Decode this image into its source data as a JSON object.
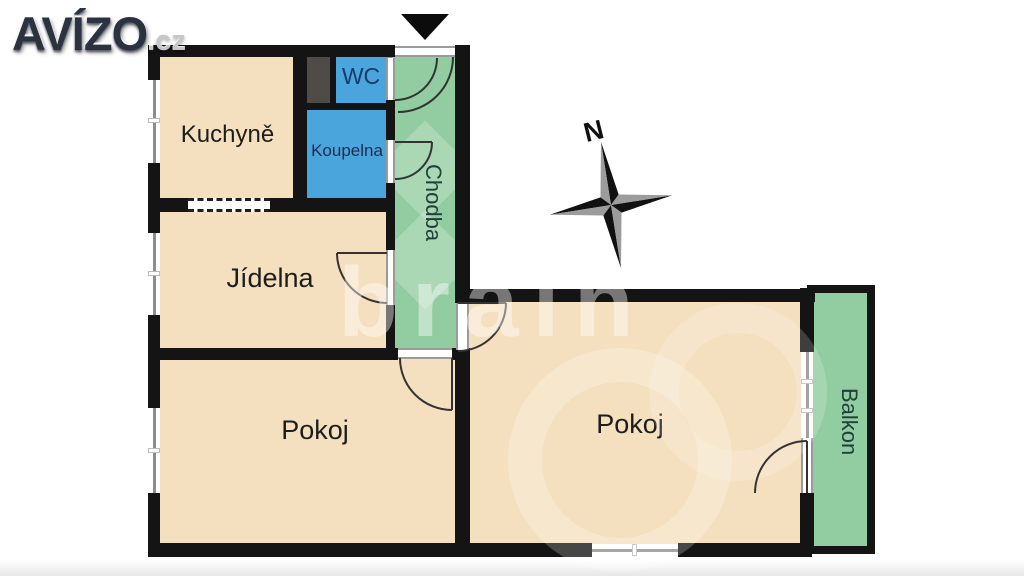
{
  "logo": {
    "brand": "AVÍZO",
    "suffix": ".cz"
  },
  "compass": {
    "north_label": "N"
  },
  "rooms": {
    "kuchyne": {
      "label": "Kuchyně"
    },
    "wc": {
      "label": "WC"
    },
    "koupelna": {
      "label": "Koupelna"
    },
    "chodba": {
      "label": "Chodba"
    },
    "jidelna": {
      "label": "Jídelna"
    },
    "pokoj_left": {
      "label": "Pokoj"
    },
    "pokoj_right": {
      "label": "Pokoj"
    },
    "balkon": {
      "label": "Balkon"
    }
  },
  "watermark": {
    "text": "brain"
  },
  "colors": {
    "wall": "#141414",
    "room_beige": "#f4e0bf",
    "room_blue": "#4ba5dd",
    "room_green": "#92cda1",
    "shaft_gray": "#4f4b47",
    "wc_text_navy": "#183a6e",
    "koupelna_text_navy": "#1f2c4d",
    "green_room_text": "#1d4136",
    "logo_navy": "#2b3240"
  }
}
